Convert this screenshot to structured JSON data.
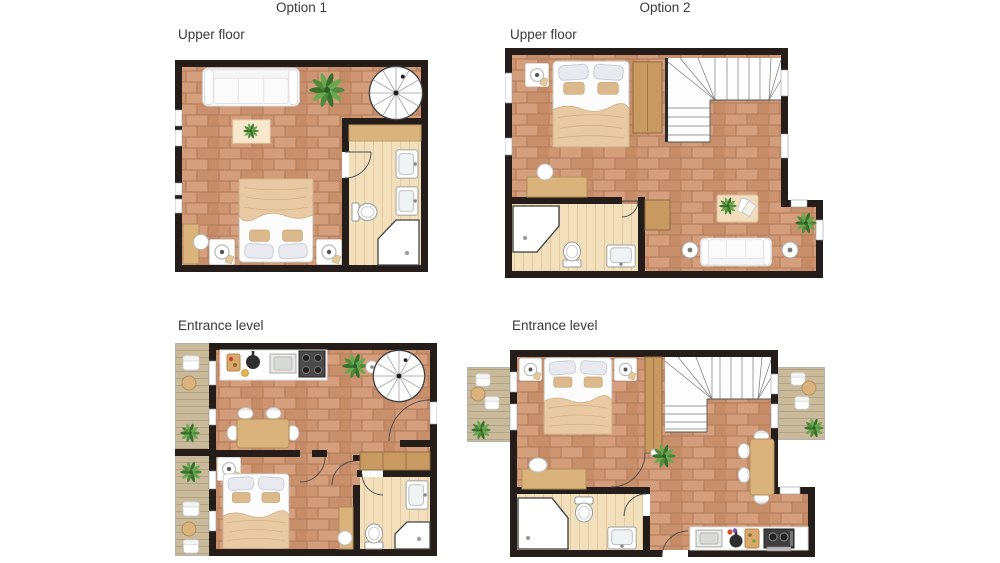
{
  "columns": [
    {
      "title": "Option 1"
    },
    {
      "title": "Option 2"
    }
  ],
  "plans": [
    {
      "id": "option1-upper",
      "column": "Option 1",
      "label": "Upper floor",
      "rooms": [
        "bedroom",
        "bathroom"
      ],
      "features": [
        "sofa",
        "potted-plant",
        "spiral-staircase",
        "rug-with-plant",
        "double-bed",
        "two-bedside-lamp-tables",
        "corner-desk-with-chair",
        "left-wall-windows",
        "bathroom-shelf",
        "double-sink-vanity",
        "toilet",
        "corner-shower",
        "bathroom-door"
      ]
    },
    {
      "id": "option2-upper",
      "column": "Option 2",
      "label": "Upper floor",
      "rooms": [
        "bedroom",
        "stair-landing",
        "bathroom",
        "lounge"
      ],
      "features": [
        "double-bed",
        "nightstand-with-lamp",
        "wardrobe",
        "u-shaped-staircase",
        "desk-with-chair",
        "corner-shower",
        "toilet",
        "sink",
        "cabinet",
        "coffee-table-with-magazines",
        "sofa",
        "two-round-lamp-tables",
        "potted-plants",
        "windows"
      ]
    },
    {
      "id": "option1-entrance",
      "column": "Option 1",
      "label": "Entrance level",
      "rooms": [
        "kitchen-dining",
        "bedroom",
        "bathroom",
        "two-balconies"
      ],
      "features": [
        "kitchen-counter-with-sink-and-stove",
        "spiral-staircase",
        "potted-plants",
        "dining-table-with-chairs",
        "entrance-door",
        "wardrobe",
        "double-bed",
        "nightstand-with-lamp",
        "desk-with-stool",
        "sink",
        "toilet",
        "corner-shower",
        "balcony-chairs-and-tables"
      ]
    },
    {
      "id": "option2-entrance",
      "column": "Option 2",
      "label": "Entrance level",
      "rooms": [
        "bedroom",
        "stair-hall",
        "dining-area",
        "bathroom",
        "kitchen",
        "two-balconies"
      ],
      "features": [
        "double-bed",
        "two-nightstands-with-lamps",
        "wardrobe",
        "u-shaped-staircase",
        "desk-with-chair",
        "dining-table-with-chairs",
        "corner-shower",
        "toilet",
        "sink",
        "kitchen-counter-with-sink-and-stove",
        "front-door",
        "potted-plants",
        "balcony-chairs-and-tables"
      ]
    }
  ],
  "palette": {
    "wall": "#241d1a",
    "brick_floor": "#cf9674",
    "brick_grout": "#b5805d",
    "bathroom_floor": "#f2dfbc",
    "deck_floor": "#c9ba9b",
    "wood_furniture": "#d9b27c",
    "wardrobe_wood": "#c89a62",
    "plant_green": "#4f8a3d",
    "white_furniture": "#ffffff",
    "background": "#ffffff"
  }
}
